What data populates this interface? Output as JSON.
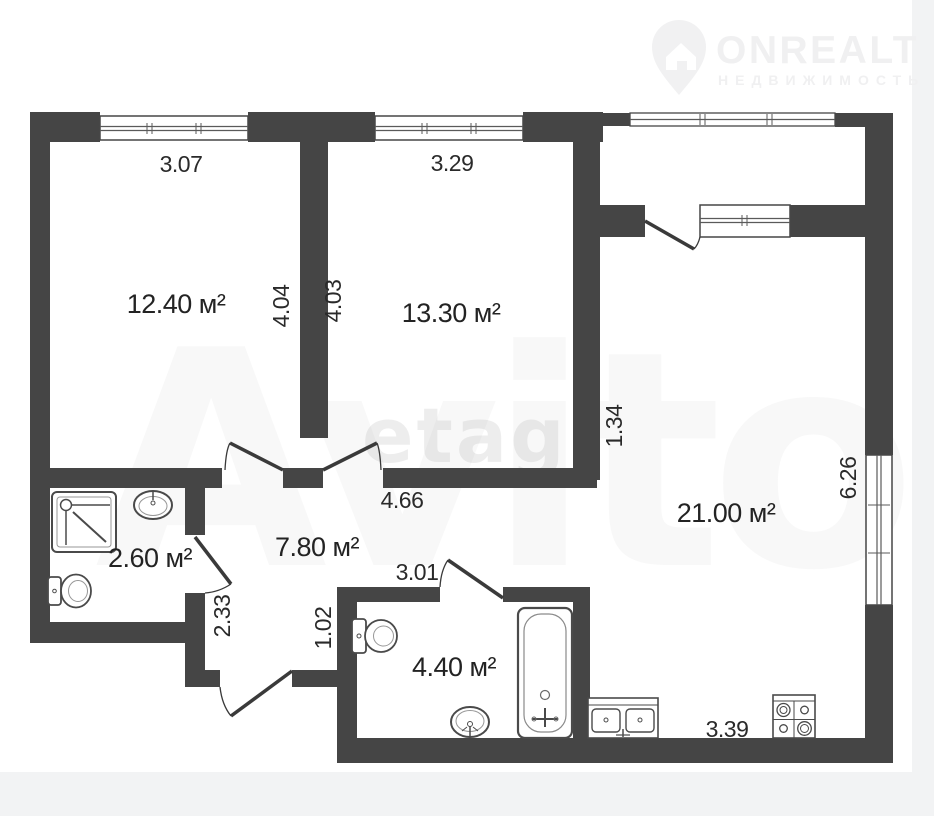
{
  "logo": {
    "brand": "ONREALT",
    "tagline": "НЕДВИЖИМОСТЬ"
  },
  "watermark": {
    "primary": "etagi",
    "secondary": "Avito"
  },
  "rooms": {
    "bedroom1": {
      "area": "12.40 м²"
    },
    "bedroom2": {
      "area": "13.30 м²"
    },
    "living": {
      "area": "21.00 м²"
    },
    "hall": {
      "area": "7.80 м²"
    },
    "wc": {
      "area": "2.60 м²"
    },
    "bathroom": {
      "area": "4.40 м²"
    }
  },
  "dims": {
    "top_bedroom1": "3.07",
    "top_bedroom2": "3.29",
    "right_bedroom1": "4.04",
    "left_bedroom2": "4.03",
    "living_opening": "1.34",
    "hall_width": "4.66",
    "living_height": "6.26",
    "hall_left": "2.33",
    "hall_right": "1.02",
    "bathroom_width": "3.01",
    "kitchen_width": "3.39"
  },
  "fixtures": [
    "shower",
    "washbasin",
    "toilet",
    "bathtub",
    "kitchen-sink",
    "stove"
  ],
  "colors": {
    "wall": "#454545",
    "line": "#3a3a3a",
    "label": "#2a2a2a",
    "page_margin": "#f2f3f4",
    "logo": "#f0f0f1"
  }
}
